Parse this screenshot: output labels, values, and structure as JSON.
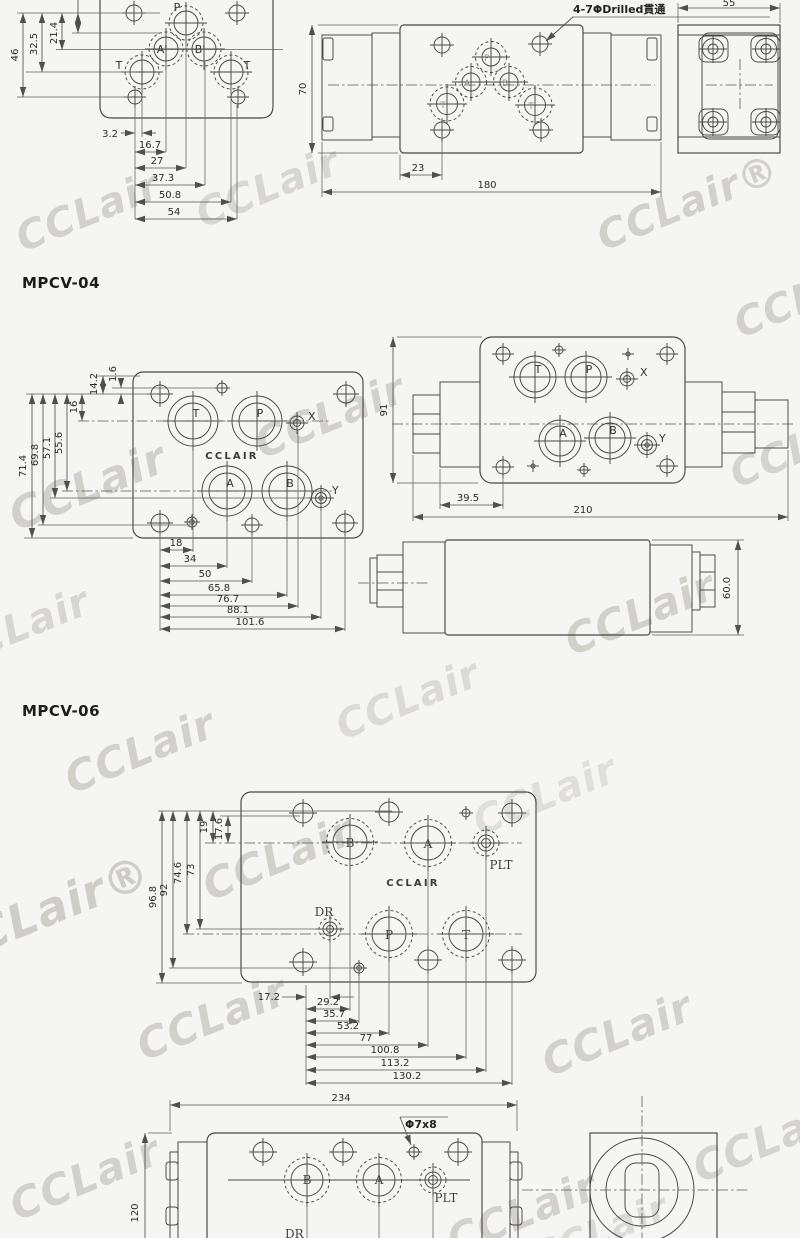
{
  "watermark": {
    "text": "CCLair",
    "text_registered": "CCLair®"
  },
  "top_section": {
    "plate_view": {
      "ports": {
        "p": "P",
        "a": "A'",
        "b": "B'",
        "t_left": "T",
        "t_right": "T"
      },
      "dims": {
        "v1": "46",
        "v2": "32.5",
        "v3": "21.4",
        "w1": "3.2",
        "w2": "16.7",
        "w3": "27",
        "w4": "37.3",
        "w5": "50.8",
        "w6": "54"
      }
    },
    "front_view": {
      "note": "4-7ΦDrilled貫通",
      "ports": {
        "p": "P",
        "a": "A",
        "b": "B",
        "t_left": "T",
        "t_right": "T"
      },
      "dims": {
        "height": "70",
        "offset": "23",
        "width": "180"
      }
    },
    "end_view": {
      "dims": {
        "width": "55"
      }
    }
  },
  "mpcv04": {
    "title": "MPCV-04",
    "plate_view": {
      "brand": "CCLAIR",
      "ports": {
        "t": "T",
        "p": "P",
        "x": "X",
        "a": "A",
        "b": "B",
        "y": "Y"
      },
      "dims_left": [
        "71.4",
        "69.8",
        "57.1",
        "55.6",
        "16",
        "14.2",
        "1.6"
      ],
      "dims_bottom": [
        "18",
        "34",
        "50",
        "65.8",
        "76.7",
        "88.1",
        "101.6"
      ]
    },
    "front_view": {
      "ports": {
        "t": "T",
        "p": "P",
        "x": "X",
        "a": "A",
        "b": "B",
        "y": "Y"
      },
      "dims": {
        "height": "91",
        "offset": "39.5",
        "width": "210"
      }
    },
    "side_view": {
      "dims": {
        "height": "60.0"
      }
    }
  },
  "mpcv06": {
    "title": "MPCV-06",
    "plate_view": {
      "brand": "CCLAIR",
      "ports": {
        "b": "B",
        "a": "A",
        "plt": "PLT",
        "dr": "DR",
        "p": "P",
        "t": "T"
      },
      "dims_left": [
        "96.8",
        "92",
        "74.6",
        "73",
        "19",
        "17.6"
      ],
      "dims_bottom": [
        "17.2",
        "29.2",
        "35.7",
        "53.2",
        "77",
        "100.8",
        "113.2",
        "130.2"
      ]
    },
    "front_view": {
      "width_dim": "234",
      "height_dim": "120",
      "note": "Φ7x8",
      "ports": {
        "b": "B",
        "a": "A",
        "plt": "PLT"
      },
      "partial_label": "DR"
    }
  }
}
